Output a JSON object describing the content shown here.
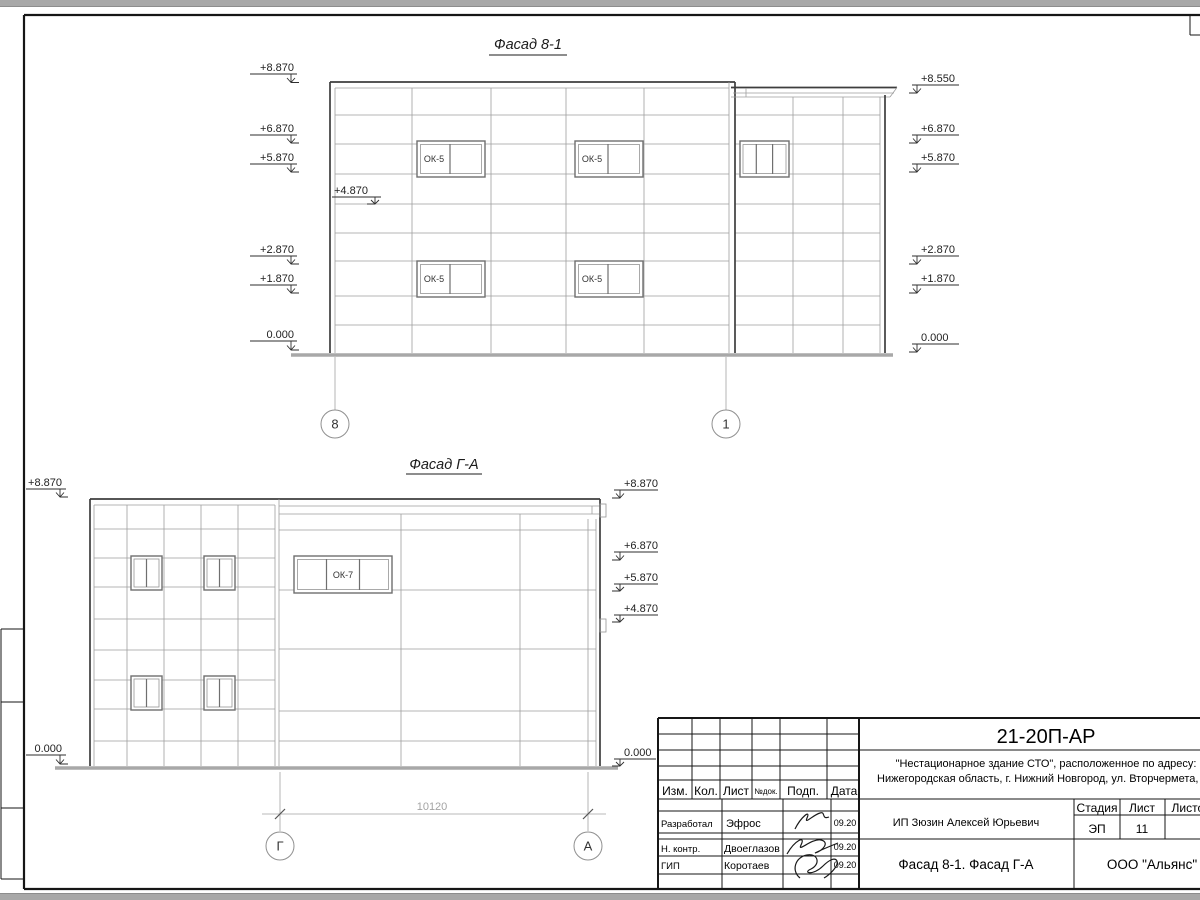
{
  "drawing": {
    "facade_81": {
      "title": "Фасад 8-1",
      "window_label": "ОК-5",
      "axis_left": "8",
      "axis_right": "1",
      "marks_left": [
        "+8.870",
        "+6.870",
        "+5.870",
        "+2.870",
        "+1.870",
        "0.000"
      ],
      "mark_inner": "+4.870",
      "marks_right": [
        "+8.550",
        "+6.870",
        "+5.870",
        "+2.870",
        "+1.870",
        "0.000"
      ]
    },
    "facade_ga": {
      "title": "Фасад Г-А",
      "window_label": "ОК-7",
      "axis_left": "Г",
      "axis_right": "А",
      "dimension": "10120",
      "marks_left": [
        "+8.870",
        "0.000"
      ],
      "marks_right": [
        "+8.870",
        "+6.870",
        "+5.870",
        "+4.870",
        "0.000"
      ]
    }
  },
  "title_block": {
    "code": "21-20П-АР",
    "project_line1": "\"Нестационарное здание СТО\", расположенное по адресу:",
    "project_line2": "Нижегородская область, г. Нижний Новгород, ул. Вторчермета, 1А",
    "customer": "ИП Зюзин Алексей Юрьевич",
    "doc_title": "Фасад 8-1. Фасад Г-А",
    "company": "ООО \"Альянс\"",
    "header": {
      "izm": "Изм.",
      "kol": "Кол.",
      "list": "Лист",
      "ndok": "№док.",
      "podp": "Подп.",
      "data": "Дата"
    },
    "stage_label": "Стадия",
    "sheet_label": "Лист",
    "sheets_label": "Листов",
    "stage_value": "ЭП",
    "sheet_value": "11",
    "rows": [
      {
        "role": "Разработал",
        "name": "Эфрос",
        "date": "09.20"
      },
      {
        "role": "Н. контр.",
        "name": "Двоеглазов",
        "date": "09.20"
      },
      {
        "role": "ГИП",
        "name": "Коротаев",
        "date": "09.20"
      }
    ]
  }
}
